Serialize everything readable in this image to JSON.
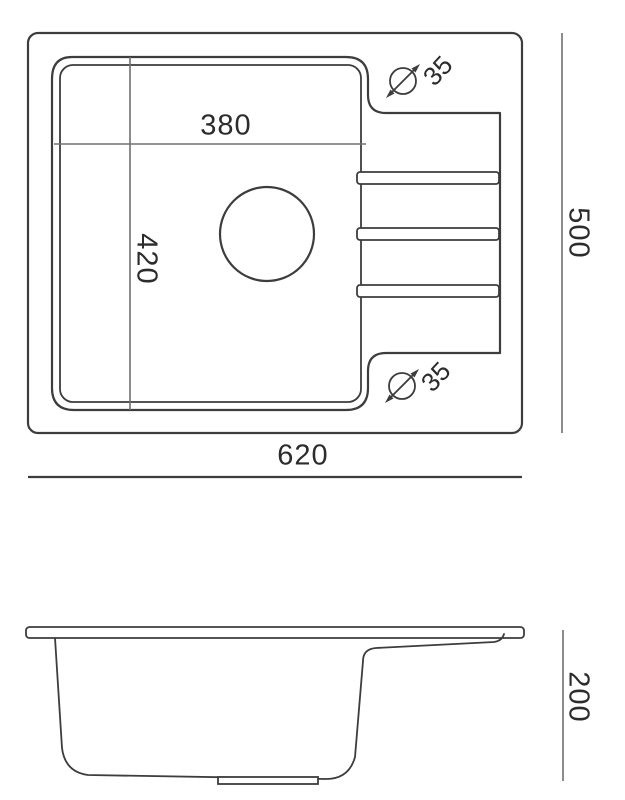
{
  "colors": {
    "line": "#3d3d3d",
    "dim_line": "#707070",
    "text": "#2c2c2c",
    "background": "#ffffff"
  },
  "top_view": {
    "bowl_width_mm": "380",
    "bowl_depth_mm": "420",
    "overall_width_mm": "620",
    "overall_depth_mm": "500",
    "tap_hole_top_diameter_mm": "35",
    "tap_hole_bottom_diameter_mm": "35"
  },
  "side_view": {
    "height_mm": "200"
  }
}
